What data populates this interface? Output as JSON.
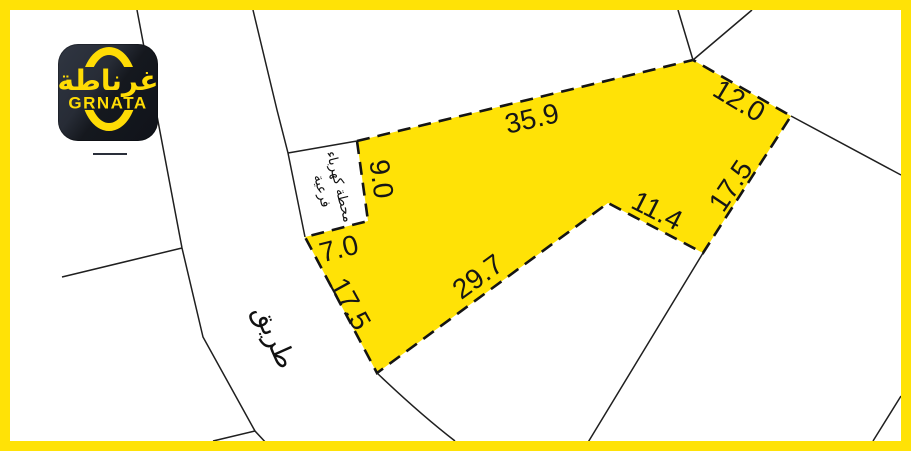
{
  "frame": {
    "color": "#FFE206"
  },
  "logo": {
    "arabic": "غرناطة",
    "latin": "GRNATA"
  },
  "map": {
    "road_label": "طريق",
    "substation_label_line1": "محطة كهرباء",
    "substation_label_line2": "فرعية",
    "plot": {
      "fill": "#FFE206",
      "outline_style": "dashed",
      "dimensions": [
        "35.9",
        "12.0",
        "17.5",
        "11.4",
        "29.7",
        "17.5",
        "7.0",
        "9.0"
      ]
    }
  }
}
